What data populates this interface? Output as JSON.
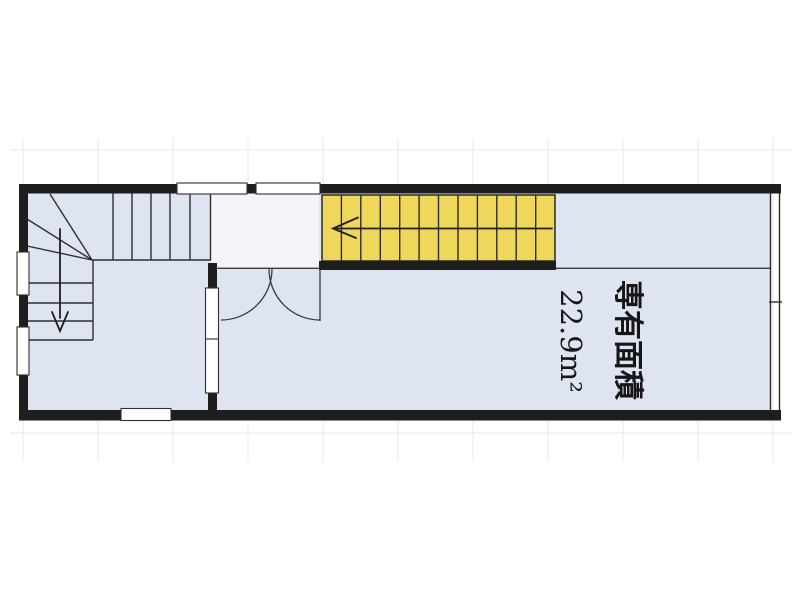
{
  "floorplan": {
    "area_label": "専有面積",
    "area_value": "22.9m²",
    "colors": {
      "floor": "#dfe4f1",
      "landing": "#f2f4fa",
      "stair_highlight": "#efd75c",
      "wall": "#1e1e1e",
      "grid": "#e7e9ee"
    }
  }
}
